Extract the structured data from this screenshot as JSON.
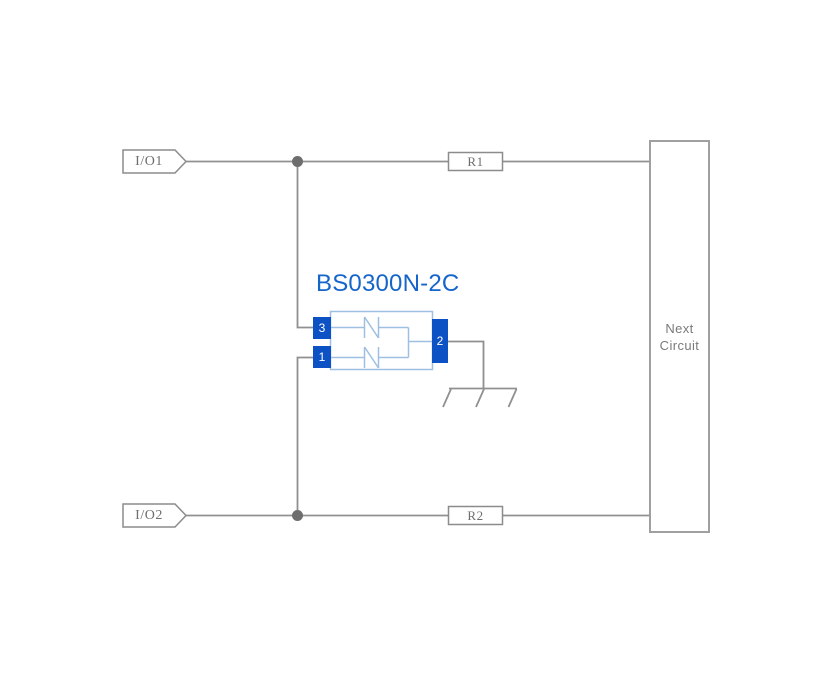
{
  "diagram": {
    "title": "BS0300N-2C",
    "connectors": [
      {
        "id": "io1",
        "label": "I/O1"
      },
      {
        "id": "io2",
        "label": "I/O2"
      }
    ],
    "resistors": [
      {
        "id": "r1",
        "label": "R1"
      },
      {
        "id": "r2",
        "label": "R2"
      }
    ],
    "component": {
      "pins": {
        "left_top": "3",
        "left_bottom": "1",
        "right": "2"
      }
    },
    "next_circuit": {
      "line1": "Next",
      "line2": "Circuit"
    }
  },
  "colors": {
    "wire": "#909090",
    "junction": "#6d6d6d",
    "symbol_border": "#8c8c8c",
    "box_border": "#a0a0a0",
    "label_text": "#6e6e6e",
    "next_text": "#7a7a7a",
    "title_blue": "#1565cb",
    "pin_blue": "#0d52c4",
    "light_blue": "#9fbfe2"
  }
}
